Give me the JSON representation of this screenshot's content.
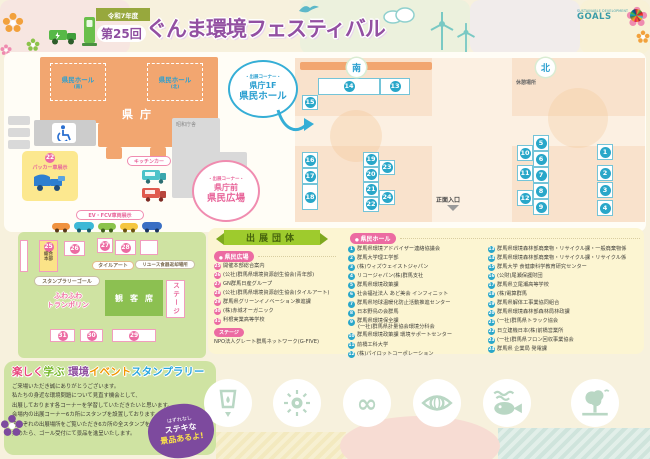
{
  "header": {
    "era": "令和7年度",
    "edition": "第25回",
    "title": "ぐんま環境フェスティバル",
    "sdgs_small": "SUSTAINABLE DEVELOPMENT",
    "sdgs_big": "GOALS"
  },
  "map": {
    "kencho": "県庁",
    "wing_south": {
      "name": "県民ホール",
      "sub": "(南)"
    },
    "wing_north": {
      "name": "県民ホール",
      "sub": "(北)"
    },
    "showa": "昭和庁舎",
    "kitchen_car": "キッチンカー",
    "packer": {
      "num": "22",
      "label": "パッカー車展示"
    },
    "ev_label": "EV・FCV車両展示",
    "corner_hall": {
      "tag": "・出展コーナー・",
      "line1": "県庁1F",
      "line2": "県民ホール"
    },
    "corner_plaza": {
      "tag": "・出展コーナー・",
      "line1": "県庁前",
      "line2": "県民広場"
    },
    "badge_south": "南",
    "badge_north": "北",
    "rest_area": "休憩場所",
    "entrance": "正面入口",
    "hq": {
      "num": "25",
      "line1": "総合",
      "line2": "本部"
    },
    "tile_art": "タイルアート",
    "reuse_label": "リユース食器返却場所",
    "stamp_goal": "スタンプラリーゴール",
    "trampoline": {
      "line1": "ふわふわ",
      "line2": "トランポリン"
    },
    "audience": "観客席",
    "stage": "ステージ"
  },
  "booths": {
    "hall": [
      "1",
      "2",
      "3",
      "4",
      "5",
      "6",
      "7",
      "8",
      "9",
      "10",
      "11",
      "12",
      "13",
      "14",
      "15",
      "16",
      "17",
      "18",
      "19",
      "20",
      "21",
      "22",
      "23",
      "24"
    ],
    "plaza": [
      "26",
      "27",
      "28",
      "29",
      "30",
      "31"
    ]
  },
  "exhibitors": {
    "panel_title": "出展団体",
    "sections": {
      "plaza": "県民広場",
      "hall": "県民ホール"
    },
    "stage_label": "ステージ",
    "stage_item": "NPO法人グレート群馬ネットワーク(G-FIVE)",
    "plaza_items": [
      {
        "num": "25",
        "name": "開催本部総合案内"
      },
      {
        "num": "26",
        "name": "(公社)群馬県環境資源創生協会(青年部)"
      },
      {
        "num": "27",
        "name": "GN群馬日産グループ"
      },
      {
        "num": "28",
        "name": "(公社)群馬県環境資源創生協会(タイルアート)"
      },
      {
        "num": "29",
        "name": "群馬県グリーンイノベーション推進課"
      },
      {
        "num": "30",
        "name": "(株)赤城オーガニック"
      },
      {
        "num": "31",
        "name": "利根実業高等学校"
      }
    ],
    "hall_items_left": [
      {
        "num": "1",
        "name": "群馬県環境アドバイザー連絡協議会"
      },
      {
        "num": "2",
        "name": "群馬大学理工学部"
      },
      {
        "num": "3",
        "name": "(株)ウィズウェイストジャパン"
      },
      {
        "num": "4",
        "name": "リコージャパン(株)群馬支社"
      },
      {
        "num": "5",
        "name": "群馬県環境政策課"
      },
      {
        "num": "6",
        "name": "社会福祉法人 あど美会 インフィニット"
      },
      {
        "num": "7",
        "name": "群馬県地球温暖化防止活動推進センター"
      },
      {
        "num": "8",
        "name": "日本野鳥の会群馬"
      },
      {
        "num": "9",
        "name": "群馬県環境保全課",
        "name2": "(一社)群馬県計量協会環境分科会"
      },
      {
        "num": "10",
        "name": "群馬県環境政策課 環境サポートセンター"
      },
      {
        "num": "11",
        "name": "前橋工科大学"
      },
      {
        "num": "12",
        "name": "(株)パイロットコーポレーション"
      }
    ],
    "hall_items_right": [
      {
        "num": "13",
        "name": "群馬県環境森林部廃棄物・リサイクル課・一般廃棄物係"
      },
      {
        "num": "14",
        "name": "群馬県環境森林部廃棄物・リサイクル課・リサイクル係"
      },
      {
        "num": "15",
        "name": "群馬大学 食健康科学教育研究センター"
      },
      {
        "num": "16",
        "name": "(公財)尾瀬保護財団"
      },
      {
        "num": "17",
        "name": "群馬県立尾瀬高等学校"
      },
      {
        "num": "18",
        "name": "(株)電算群馬"
      },
      {
        "num": "19",
        "name": "群馬県解体工事業協同組合"
      },
      {
        "num": "20",
        "name": "群馬県環境森林部森林局林政課"
      },
      {
        "num": "21",
        "name": "(一社)群馬県トラック協会"
      },
      {
        "num": "22",
        "name": "日立建機日本(株)前橋営業所"
      },
      {
        "num": "23",
        "name": "(一社)群馬県フロン回収事業協会"
      },
      {
        "num": "24",
        "name": "群馬県 企業局 発電課"
      }
    ]
  },
  "stamp_rally": {
    "title_parts": [
      {
        "text": "楽しく",
        "color": "#e8467c"
      },
      {
        "text": "学ぶ ",
        "color": "#76b82a"
      },
      {
        "text": "環境",
        "color": "#8e4ea0"
      },
      {
        "text": "イベント",
        "color": "#f29600"
      },
      {
        "text": "スタンプラリー",
        "color": "#2ca6de"
      }
    ],
    "lines": [
      "ご来場いただき誠にありがとうございます。",
      "私たちの身近な環境問題について見直す機会として、",
      "出展しております各コーナーを学習していただきたいと思います。",
      "会場内の出展コーナー6カ所にスタンプを設置しております。",
      "それぞれの出展場所をご覧いただき6カ所の全スタンプを",
      "集めたら、ゴール受付にて景品を進呈いたします。"
    ],
    "badge": {
      "ribbon": "はずれなし",
      "line1": "ステキな",
      "line2": "景品あるよ!"
    }
  },
  "icons": {
    "sdg_circle_icons": [
      "water-glass-icon",
      "sun-energy-icon",
      "infinity-icon",
      "eye-globe-icon",
      "fish-icon",
      "tree-icon"
    ],
    "infinity_glyph": "∞"
  },
  "colors": {
    "title_purple": "#9350a2",
    "building_orange": "#f2a670",
    "hall_floor": "#f9e2cc",
    "plaza_green": "#cfe3a2",
    "booth_blue": "#29a7c9",
    "booth_pink": "#ec6ba2",
    "panel_yellow": "#fcf5d2",
    "ribbon_green": "#9ecb2d",
    "badge_purple": "#7d4a9e"
  }
}
